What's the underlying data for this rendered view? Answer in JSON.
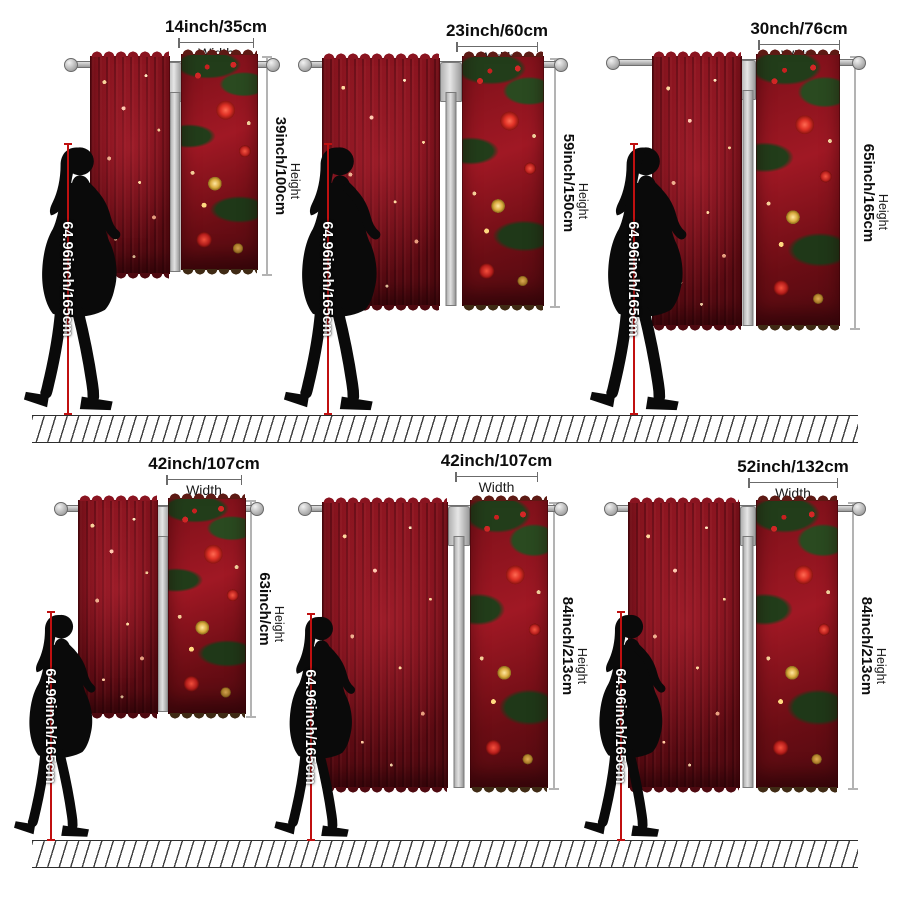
{
  "captions": {
    "width": "Width",
    "height": "Height"
  },
  "woman": {
    "label": "64.96inch/165cm"
  },
  "panels": [
    {
      "width_label": "14inch/35cm",
      "height_label": "39inch/100cm"
    },
    {
      "width_label": "23inch/60cm",
      "height_label": "59inch/150cm"
    },
    {
      "width_label": "30nch/76cm",
      "height_label": "65inch/165cm"
    },
    {
      "width_label": "42inch/107cm",
      "height_label": "63inch/cm"
    },
    {
      "width_label": "42inch/107cm",
      "height_label": "84inch/213cm"
    },
    {
      "width_label": "52inch/132cm",
      "height_label": "84inch/213cm"
    }
  ],
  "colors": {
    "measure_line": "#c01010",
    "curtain_red": "#7a0f1a",
    "ornament_gold": "#c9a227",
    "pine_green": "#2c4a22"
  }
}
